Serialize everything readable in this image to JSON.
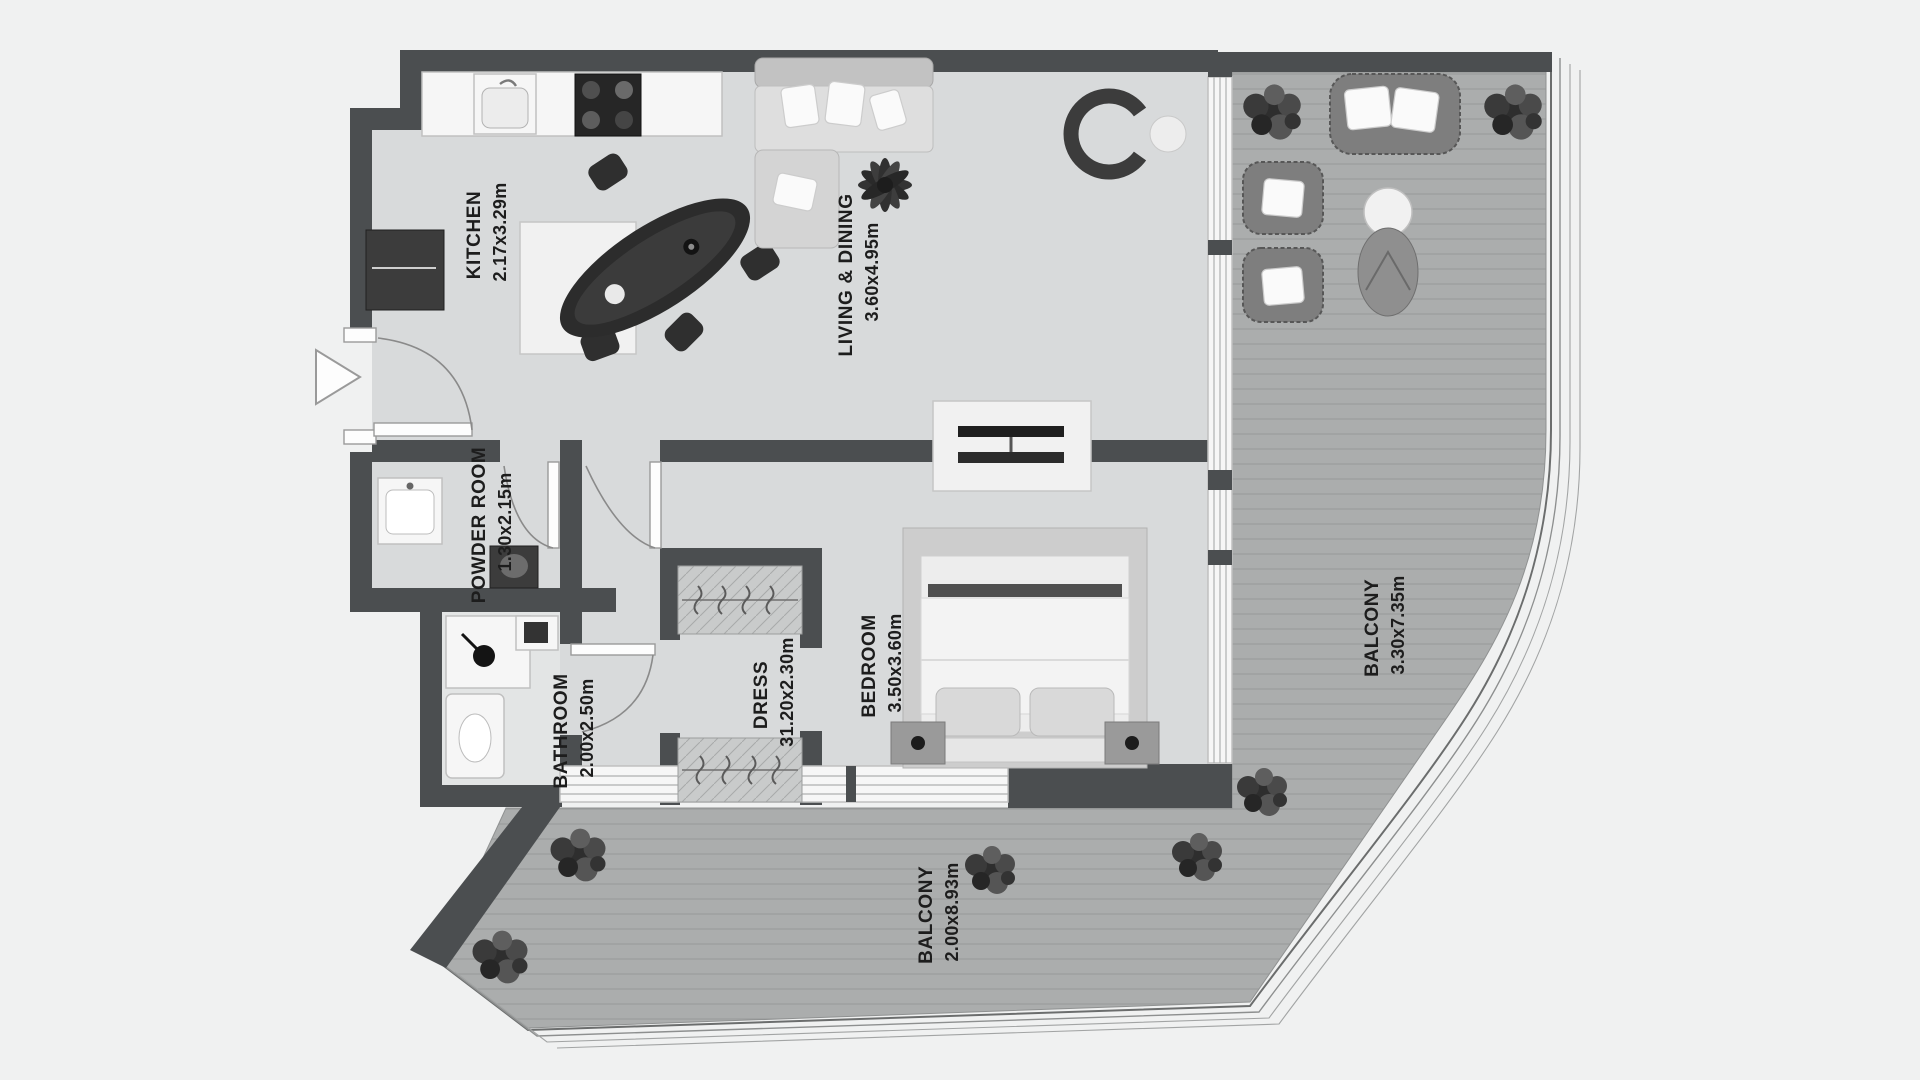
{
  "plan": {
    "title": "apartment-floor-plan",
    "style": "grayscale top-down architectural plan",
    "rooms": [
      {
        "name": "KITCHEN",
        "dims": "2.17x3.29m"
      },
      {
        "name": "LIVING & DINING",
        "dims": "3.60x4.95m"
      },
      {
        "name": "POWDER ROOM",
        "dims": "1.30x2.15m"
      },
      {
        "name": "BATHROOM",
        "dims": "2.00x2.50m"
      },
      {
        "name": "DRESS",
        "dims": "31.20x2.30m"
      },
      {
        "name": "BEDROOM",
        "dims": "3.50x3.60m"
      },
      {
        "name": "BALCONY",
        "dims": "3.30x7.35m"
      },
      {
        "name": "BALCONY",
        "dims": "2.00x8.93m"
      }
    ],
    "entry": {
      "marker": "entrance-arrow",
      "side": "left"
    },
    "colors": {
      "wall": "#4b4e50",
      "floor": "#d8dadb",
      "balcony_floor": "#abadad",
      "background": "#f0f1f1",
      "label": "#1d1d1d",
      "fixture_white": "#f6f6f6",
      "fixture_dark": "#373737"
    }
  }
}
